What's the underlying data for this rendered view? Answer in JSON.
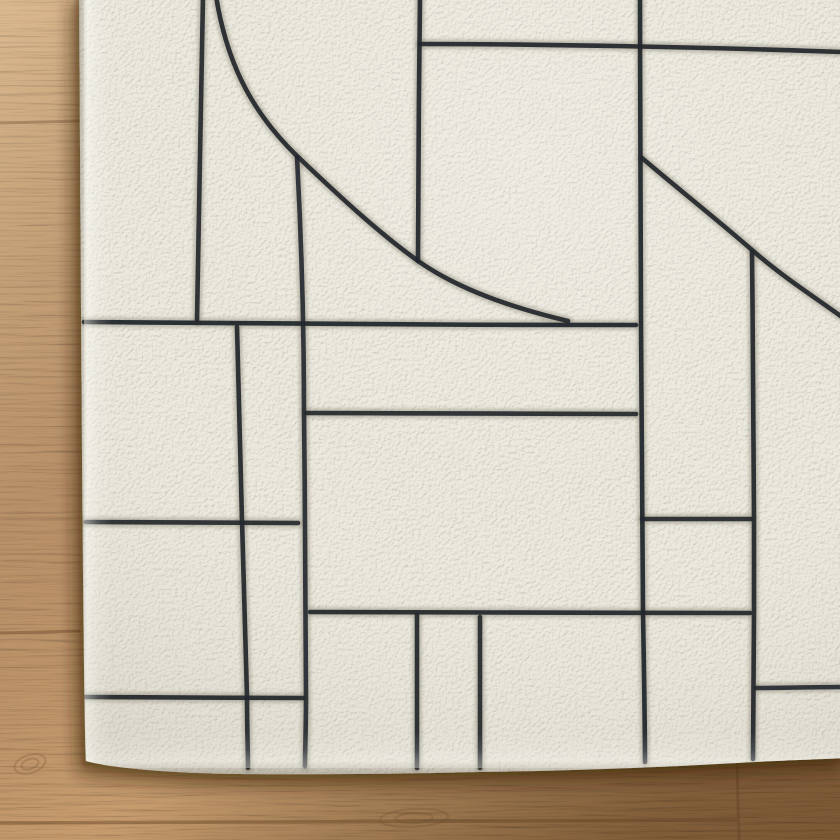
{
  "scene": {
    "type": "photograph",
    "subject": "corner of an ivory hand-tufted wool rug with a carved black geometric line pattern (grid of irregular rectangles, one large sweeping quarter-circle arc and one long diagonal)",
    "setting": "light oak hardwood plank floor visible along the left side and bottom",
    "width_px": 840,
    "height_px": 840
  },
  "colors": {
    "rug_base": "#edeadf",
    "rug_edge_highlight": "#fbfaf2",
    "pattern_line": "#24282d",
    "pattern_groove_shadow": "rgba(138,132,116,0.45)",
    "floor_light": "#d6ad7e",
    "floor_mid": "#c2966a",
    "floor_dark": "#a0764a",
    "plank_seam": "#7c5833",
    "rug_drop_shadow": "#3a2511"
  },
  "pattern": {
    "stroke_width": 4.6,
    "paths": [
      {
        "name": "arc-curve",
        "d": "M216,-4 C226,58 248,108 296,155 C339,196 381,235 421,263 C459,289 509,307 568,321",
        "o": 0.93
      },
      {
        "name": "vertical-line-a",
        "d": "M203,-4 C201,90 199,220 197,320",
        "o": 0.92
      },
      {
        "name": "vertical-line-b",
        "d": "M297,157 C302,250 304,340 304,414 C305,510 306,610 306,698 C306,726 305,752 305,766",
        "o": 0.9
      },
      {
        "name": "vertical-line-c",
        "d": "M420,-4 C419,80 418,190 418,261",
        "o": 0.93
      },
      {
        "name": "vertical-line-d",
        "d": "M640,-4 C640,110 641,230 641,324 C642,430 643,530 643,612 C644,675 645,725 645,762",
        "o": 0.95
      },
      {
        "name": "vertical-line-e",
        "d": "M752,252 C753,350 754,460 754,518 C754,555 754,585 754,612 C754,668 753,718 753,759",
        "o": 0.93
      },
      {
        "name": "vertical-line-f",
        "d": "M237,327 C239,400 241,470 242,521 C244,585 246,650 247,697 C247,728 248,752 248,768",
        "o": 0.93
      },
      {
        "name": "vertical-line-g",
        "d": "M417,615 C417,665 417,725 417,768",
        "o": 0.93
      },
      {
        "name": "vertical-line-h",
        "d": "M480,617 C480,665 480,725 480,768",
        "o": 0.92
      },
      {
        "name": "horizontal-line-top",
        "d": "M420,44 C540,44 700,47 842,52",
        "o": 0.93
      },
      {
        "name": "horizontal-line-1",
        "d": "M84,322 C250,324 450,325 636,325",
        "o": 0.95
      },
      {
        "name": "horizontal-line-2",
        "d": "M306,413 C410,413 540,414 636,414",
        "o": 0.92
      },
      {
        "name": "horizontal-line-3",
        "d": "M86,522 C150,522 230,523 298,523",
        "o": 0.92
      },
      {
        "name": "horizontal-line-4",
        "d": "M642,519 C680,519 718,519 751,519",
        "o": 0.92
      },
      {
        "name": "horizontal-line-5",
        "d": "M84,697 C150,697 230,698 303,698",
        "o": 0.93
      },
      {
        "name": "horizontal-line-6",
        "d": "M310,612 C430,612 600,613 750,613",
        "o": 0.93
      },
      {
        "name": "horizontal-line-7",
        "d": "M756,688 C782,688 815,687 842,687",
        "o": 0.9
      },
      {
        "name": "diagonal-line",
        "d": "M642,158 C682,192 720,222 752,250 C783,277 813,296 842,317",
        "o": 0.94
      }
    ]
  },
  "floor": {
    "seams": [
      {
        "x1": 0,
        "y1": 123,
        "x2": 80,
        "y2": 121,
        "w": 3
      },
      {
        "x1": 0,
        "y1": 633,
        "x2": 80,
        "y2": 631,
        "w": 3
      },
      {
        "x1": 0,
        "y1": 823,
        "x2": 737,
        "y2": 820,
        "w": 3.5
      },
      {
        "x1": 737,
        "y1": 764,
        "x2": 739,
        "y2": 840,
        "w": 3
      }
    ],
    "knots": [
      {
        "cx": 30,
        "cy": 764,
        "rx": 16,
        "ry": 9,
        "rot": -18
      },
      {
        "cx": 414,
        "cy": 818,
        "rx": 34,
        "ry": 9,
        "rot": -3
      },
      {
        "cx": 600,
        "cy": 500,
        "rx": 20,
        "ry": 7,
        "rot": -10
      }
    ]
  }
}
